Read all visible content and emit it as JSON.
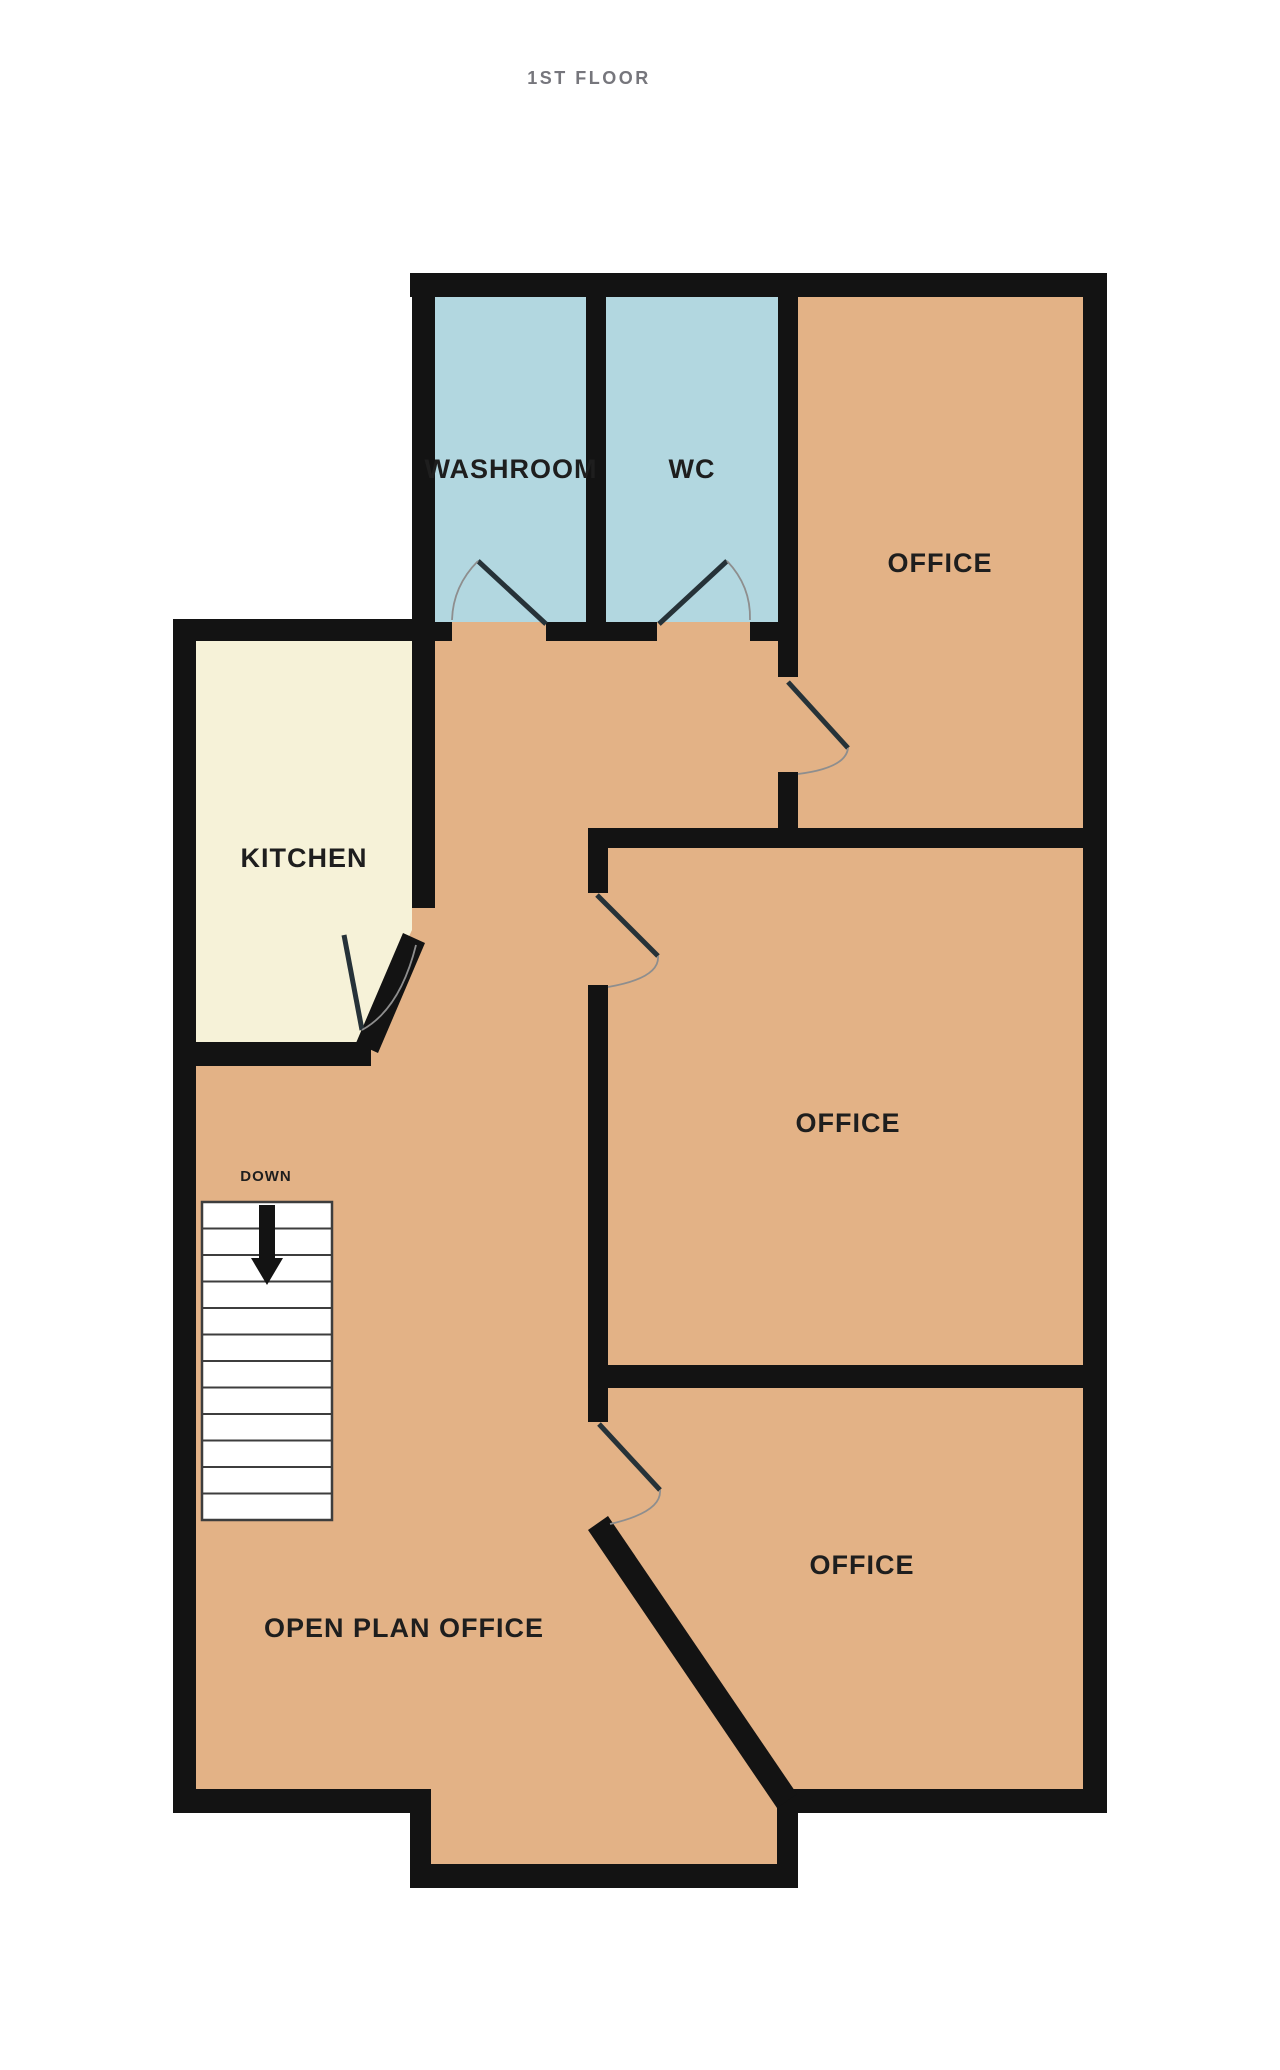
{
  "title": "1ST FLOOR",
  "rooms": {
    "washroom": {
      "label": "WASHROOM"
    },
    "wc": {
      "label": "WC"
    },
    "office_top": {
      "label": "OFFICE"
    },
    "office_middle": {
      "label": "OFFICE"
    },
    "office_bottom": {
      "label": "OFFICE"
    },
    "kitchen": {
      "label": "KITCHEN"
    },
    "open_plan_office": {
      "label": "OPEN PLAN OFFICE"
    }
  },
  "stairs": {
    "label": "DOWN",
    "direction": "down",
    "visible_treads": 12
  },
  "colors": {
    "background": "#ffffff",
    "wall": "#131313",
    "room_tan": "#e3b286",
    "wet_blue": "#b2d7e0",
    "kitchen_cream": "#f6f2d8",
    "stair_fill": "#ffffff",
    "stair_line": "#3d3d3d",
    "door_leaf": "#263238",
    "door_arc": "#8e8e8e",
    "label_dark": "#1e1e1e",
    "title_gray": "#76767c"
  }
}
